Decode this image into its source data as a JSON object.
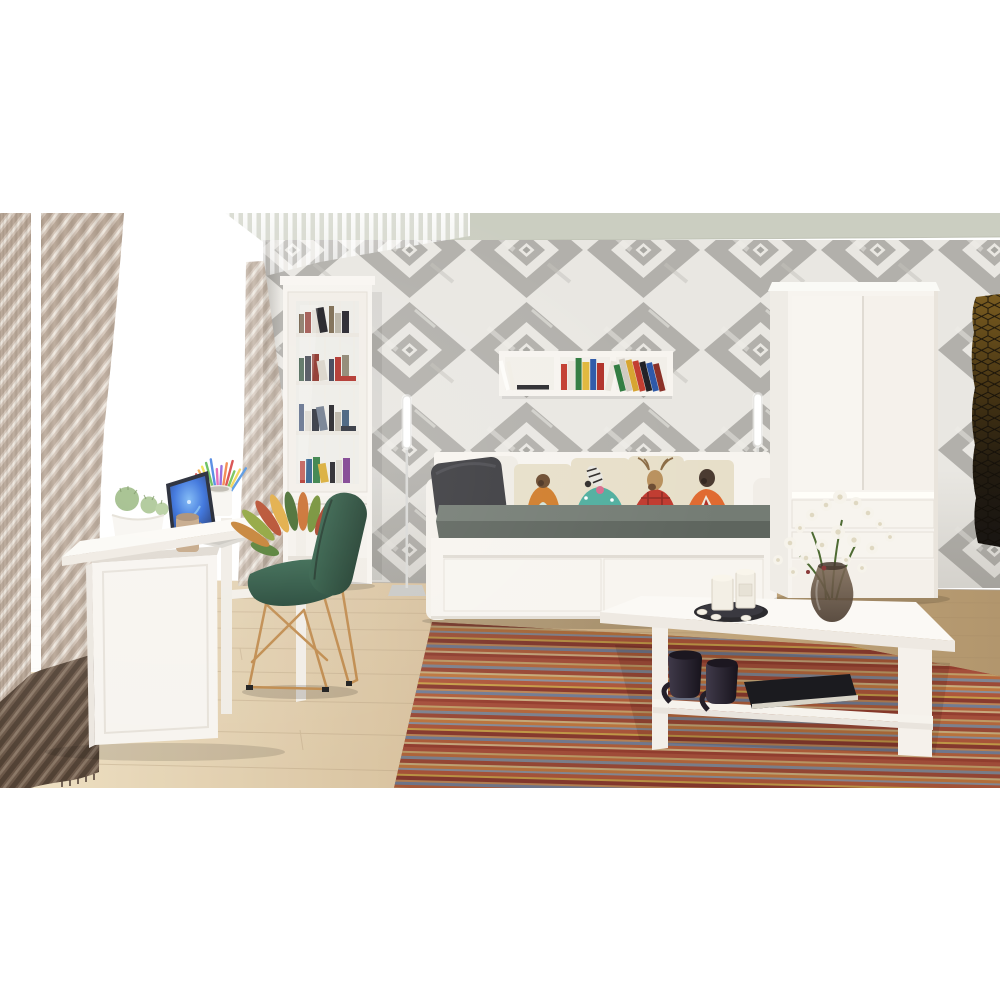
{
  "scene": {
    "type": "3d-interior-render",
    "description": "Bright room with white furniture set: daybed with animal-print pillows, tall glass display bookcase, wall box shelf with books, two-door wardrobe, desk with laptop, green wire chair, white coffee table on a striped multicolor rug, beige curtains and gray diamond-pattern wallpaper.",
    "objects": [
      {
        "name": "curtain-left",
        "desc": "beige diagonal-striped curtain panels with dark brown hem"
      },
      {
        "name": "window",
        "desc": "bright overexposed window with sheer fringe valance"
      },
      {
        "name": "curtain-sheer-right",
        "desc": "narrow beige sheer panel at window corner"
      },
      {
        "name": "wallpaper-wall",
        "desc": "gray and white concentric diamond ikat wallpaper"
      },
      {
        "name": "ceiling",
        "desc": "pale sage-gray ceiling band"
      },
      {
        "name": "display-cabinet",
        "desc": "tall white display bookcase with glass door and four book shelves"
      },
      {
        "name": "wall-shelf",
        "desc": "white 3-compartment floating box shelf with colorful books"
      },
      {
        "name": "floor-lamp-left",
        "desc": "thin white tube floor lamp"
      },
      {
        "name": "floor-lamp-right",
        "desc": "thin white tube floor lamp behind daybed"
      },
      {
        "name": "daybed",
        "desc": "white daybed with two drawers, gray mattress"
      },
      {
        "name": "pillows",
        "desc": "six cushions: dark gray, white, and four cream pillows printed with dressed animals (monkey, zebra, deer, bear)"
      },
      {
        "name": "wardrobe",
        "desc": "white two-door wardrobe with two bottom drawers"
      },
      {
        "name": "honeycomb-panel",
        "desc": "dark hexagon acoustic panel on right wall"
      },
      {
        "name": "desk",
        "desc": "white desk with side cabinet and open return"
      },
      {
        "name": "laptop",
        "desc": "open laptop with glowing blue screen"
      },
      {
        "name": "pencil-cup",
        "desc": "white cup with colorful pencils"
      },
      {
        "name": "cactus-bowl",
        "desc": "white bowl planter with green cacti"
      },
      {
        "name": "desk-mug",
        "desc": "beige mug"
      },
      {
        "name": "croton-plant",
        "desc": "croton plant with green-orange-red leaves in white pot"
      },
      {
        "name": "chair",
        "desc": "green shell chair on gold wire sled legs"
      },
      {
        "name": "coffee-table",
        "desc": "white coffee table with lower shelf"
      },
      {
        "name": "table-mugs",
        "desc": "two dark mugs on lower shelf"
      },
      {
        "name": "table-book",
        "desc": "black book on lower shelf"
      },
      {
        "name": "candle-tray",
        "desc": "dark round tray with white candles and tealights"
      },
      {
        "name": "flower-vase",
        "desc": "smoked glass vase with white flowers"
      },
      {
        "name": "rug",
        "desc": "multicolor thin-striped area rug"
      },
      {
        "name": "floor",
        "desc": "light wood plank floor"
      }
    ]
  },
  "palette": {
    "ceiling": "#cbcec1",
    "wall_bg": "#e9e7e2",
    "wall_gray": "#b2b0ab",
    "window_glow": "#ffffff",
    "curtain_beige": "#d3c4b6",
    "curtain_dark": "#6b574a",
    "furniture_white": "#f7f4ef",
    "furniture_bright": "#fbf9f5",
    "furniture_side": "#efece6",
    "mattress_top": "#747c74",
    "mattress_front": "#5e655e",
    "pillow_dark": "#3b3b3f",
    "pillow_white": "#efece5",
    "pillow_cream": "#e7dfc9",
    "chair_green": "#2d5843",
    "chair_gold": "#bf8a4c",
    "rug_base": "#a05742",
    "laptop_frame": "#0d1220",
    "laptop_body": "#d9d6cf",
    "mug_beige": "#c2a381",
    "mug_dark": "#2a242e",
    "flower_white": "#f6f3ea",
    "honeycomb_gold": "#75581f",
    "tray_dark": "#2c2b2f",
    "candle_white": "#f3efe5",
    "book_black": "#1b1b1f",
    "lamp_metal": "#d9d9d6",
    "wood_line": "#a98e68"
  },
  "rug": {
    "stripes": [
      {
        "c": "#a8503c",
        "h": 4
      },
      {
        "c": "#c4a36b",
        "h": 2
      },
      {
        "c": "#b96b3e",
        "h": 3
      },
      {
        "c": "#7e8898",
        "h": 3
      },
      {
        "c": "#9c4936",
        "h": 4
      },
      {
        "c": "#cab27f",
        "h": 2
      },
      {
        "c": "#c27a40",
        "h": 3
      },
      {
        "c": "#8a93a2",
        "h": 2
      },
      {
        "c": "#b0583c",
        "h": 4
      },
      {
        "c": "#c9a24a",
        "h": 2
      },
      {
        "c": "#8a3a2e",
        "h": 4
      },
      {
        "c": "#bf8a5a",
        "h": 2
      },
      {
        "c": "#72809a",
        "h": 3
      },
      {
        "c": "#b4603c",
        "h": 3
      },
      {
        "c": "#d0b284",
        "h": 2
      },
      {
        "c": "#983f30",
        "h": 3
      }
    ]
  },
  "bookcase_rows": [
    {
      "colors": [
        "#6e5a44",
        "#8a2f26",
        "#ddd8ce",
        "#1e1d22",
        "#7b6a50",
        "#b8b2a4",
        "#23222a",
        "#8a8274"
      ],
      "lying": null
    },
    {
      "colors": [
        "#2e4c38",
        "#1e2230",
        "#8a2f26",
        "#d8d3c8",
        "#3a3f52",
        "#b03028",
        "#8c8470"
      ],
      "lying": "#b03028"
    },
    {
      "colors": [
        "#3a4c6e",
        "#d8d3c8",
        "#2a2e38",
        "#6e7a8c",
        "#1e1d22",
        "#b8b2a4",
        "#3e5a78"
      ],
      "lying": "#2a2e38"
    },
    {
      "colors": [
        "#b03028",
        "#2a5c8a",
        "#2e7a3e",
        "#d8a92e",
        "#1e1d22",
        "#d8d3c8",
        "#7a3a8c",
        "#b8632e"
      ],
      "lying": null
    }
  ],
  "wall_shelf_books": {
    "middle": [
      "#c23b2e",
      "#e8e4da",
      "#2e7a3e",
      "#e0b73a",
      "#2b57a8",
      "#b03028",
      "#e8e4da"
    ],
    "right": [
      "#2e7a3e",
      "#cfc9c0",
      "#d6a32e",
      "#c23b2e",
      "#1f1f24",
      "#2b57a8",
      "#8a2f26"
    ]
  },
  "pencils": {
    "colors": [
      "#e04444",
      "#f2a33c",
      "#efe042",
      "#58b84a",
      "#3f7de0",
      "#e05ab0",
      "#8a58d8",
      "#f27c3c",
      "#d43b3b",
      "#6abf4b",
      "#f2d24a",
      "#4a90e0"
    ]
  },
  "croton": {
    "colors": [
      "#4f7a2e",
      "#c27b2a",
      "#8aa032",
      "#b34524",
      "#e0a83c",
      "#3f6628",
      "#c86a28",
      "#6e8c2e",
      "#a53c22",
      "#d89a30",
      "#47702a",
      "#bf5c26",
      "#578033"
    ]
  },
  "flowers": {
    "color": "#f6f3ea",
    "positions": [
      [
        778,
        560,
        5
      ],
      [
        790,
        543,
        6
      ],
      [
        800,
        528,
        5
      ],
      [
        812,
        515,
        6
      ],
      [
        826,
        505,
        6
      ],
      [
        840,
        497,
        7
      ],
      [
        856,
        503,
        6
      ],
      [
        868,
        513,
        6
      ],
      [
        880,
        524,
        5
      ],
      [
        890,
        537,
        5
      ],
      [
        872,
        548,
        6
      ],
      [
        854,
        540,
        7
      ],
      [
        838,
        532,
        7
      ],
      [
        822,
        545,
        6
      ],
      [
        806,
        558,
        6
      ],
      [
        846,
        560,
        5
      ],
      [
        862,
        568,
        5
      ],
      [
        793,
        572,
        5
      ]
    ]
  }
}
